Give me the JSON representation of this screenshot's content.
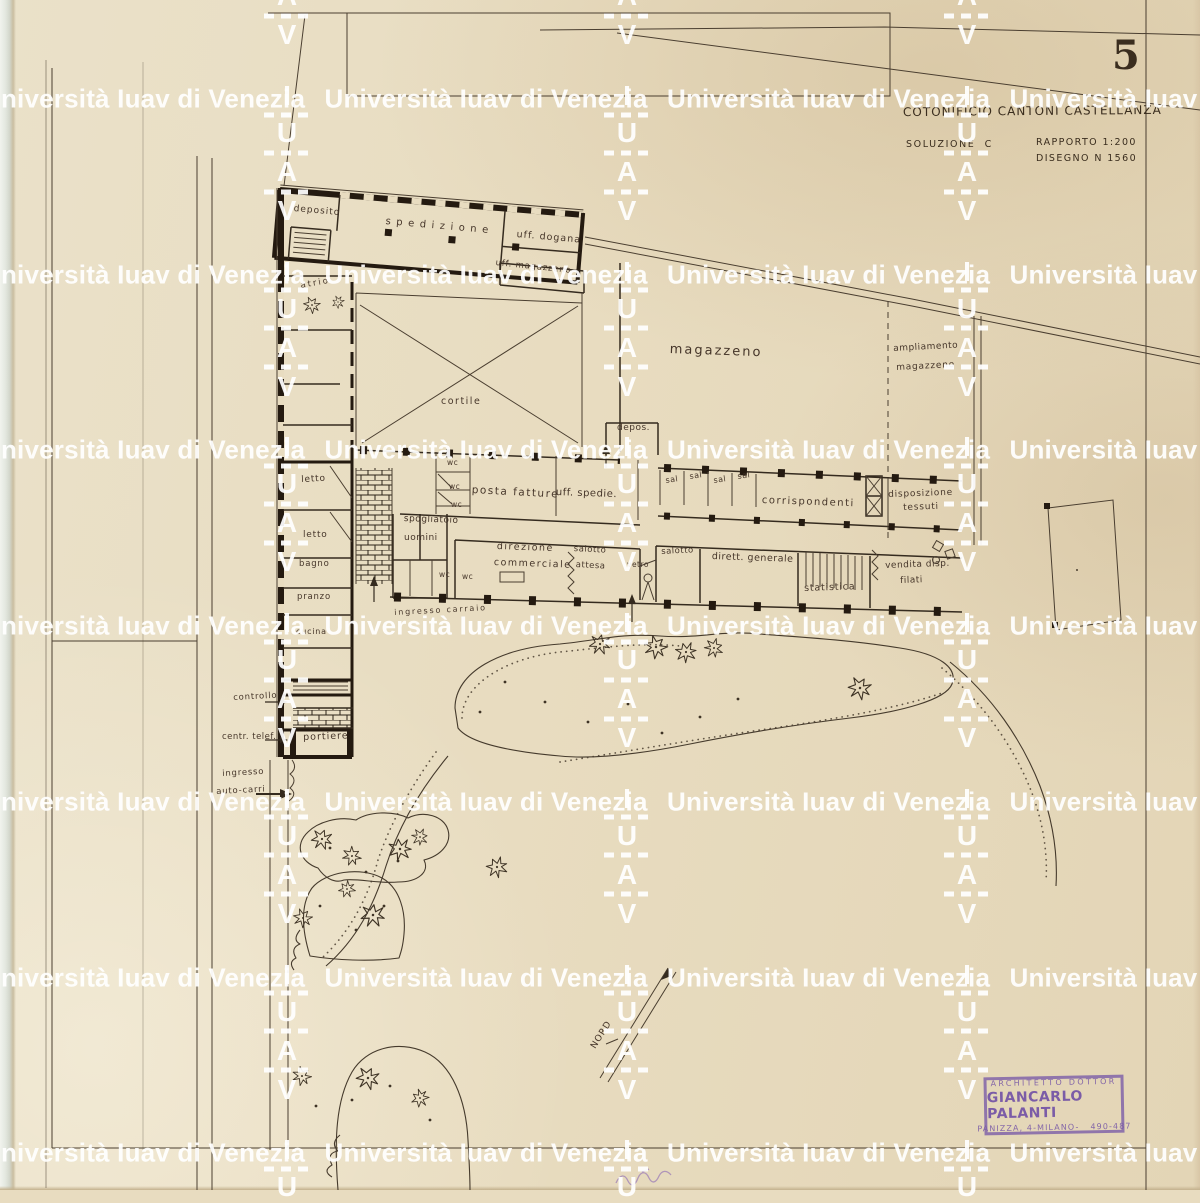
{
  "watermark": {
    "text": "Università Iuav di Venezia",
    "letters": [
      "I",
      "U",
      "A",
      "V"
    ],
    "rows": {
      "y0": 99,
      "dy": 175.7,
      "count": 7
    },
    "text_cols": {
      "x0": -18,
      "dx": 342.5,
      "count": 4
    },
    "letter_cols": {
      "x0": 287,
      "dx": 340,
      "count": 3,
      "y0": 96
    },
    "letter_offsets": [
      0,
      37,
      76,
      115
    ],
    "dash_offsets": [
      18.5,
      56.5,
      95.5
    ]
  },
  "title_block": {
    "sheet_number": "5",
    "title": "COTONIFICIO CANTONI CASTELLANZA",
    "solution": "SOLUZIONE  C",
    "scale": "RAPPORTO 1:200",
    "drawing_number": "DISEGNO N 1560"
  },
  "stamp": {
    "line1": "ARCHITETTO DOTTOR",
    "line2": "GIANCARLO PALANTI",
    "line3": "PANIZZA, 4-MILANO-   490-487"
  },
  "colors": {
    "paper": "#e8dcc0",
    "ink": "#3a2f22",
    "wall": "#241a10",
    "stamp_purple": "#7b5ca7",
    "sheet_number_purple": "#6a4b8f",
    "watermark": "#ffffff"
  },
  "plan_labels": [
    {
      "text": "deposito",
      "x": 294,
      "y": 205,
      "size": 9,
      "rot": 5,
      "ls": 1
    },
    {
      "text": "spedizione",
      "x": 386,
      "y": 217,
      "size": 10,
      "rot": 5,
      "ls": 5.5
    },
    {
      "text": "uff. dogana",
      "x": 517,
      "y": 230,
      "size": 9.5,
      "rot": 5,
      "ls": 1
    },
    {
      "text": "uff. magazzeno",
      "x": 496,
      "y": 259,
      "size": 8.5,
      "rot": 6,
      "ls": 0.8
    },
    {
      "text": "atrio",
      "x": 300,
      "y": 282,
      "size": 8.5,
      "rot": -10,
      "ls": 2
    },
    {
      "text": "cortile",
      "x": 441,
      "y": 397,
      "size": 9.5,
      "rot": 0,
      "ls": 1.5
    },
    {
      "text": "magazzeno",
      "x": 670,
      "y": 343,
      "size": 13,
      "rot": 2,
      "ls": 2
    },
    {
      "text": "ampliamento",
      "x": 893,
      "y": 345,
      "size": 9,
      "rot": -3,
      "ls": 0.5
    },
    {
      "text": "magazzeno",
      "x": 896,
      "y": 364,
      "size": 9,
      "rot": -3,
      "ls": 0.8
    },
    {
      "text": "depos.",
      "x": 617,
      "y": 424,
      "size": 9,
      "rot": 0,
      "ls": 0.5
    },
    {
      "text": "wc",
      "x": 447,
      "y": 459,
      "size": 7.5,
      "rot": 0,
      "ls": 0.5
    },
    {
      "text": "wc",
      "x": 449,
      "y": 483,
      "size": 7.5,
      "rot": 0,
      "ls": 0.5
    },
    {
      "text": "wc",
      "x": 451,
      "y": 501,
      "size": 7.5,
      "rot": 0,
      "ls": 0.5
    },
    {
      "text": "wc",
      "x": 439,
      "y": 571,
      "size": 7.5,
      "rot": 0,
      "ls": 0.5
    },
    {
      "text": "wc",
      "x": 462,
      "y": 573,
      "size": 7.5,
      "rot": 0,
      "ls": 0.5
    },
    {
      "text": "posta fatture",
      "x": 472,
      "y": 485,
      "size": 10.5,
      "rot": 3,
      "ls": 1.5
    },
    {
      "text": "uff. spedie.",
      "x": 556,
      "y": 488,
      "size": 10,
      "rot": 2,
      "ls": 0.5
    },
    {
      "text": "spogliatoio",
      "x": 404,
      "y": 515,
      "size": 9,
      "rot": 2,
      "ls": 0.5
    },
    {
      "text": "uomini",
      "x": 404,
      "y": 534,
      "size": 9,
      "rot": 0,
      "ls": 0.5
    },
    {
      "text": "direzione",
      "x": 497,
      "y": 542,
      "size": 9.5,
      "rot": 2,
      "ls": 1.5
    },
    {
      "text": "commerciale",
      "x": 494,
      "y": 558,
      "size": 9.5,
      "rot": 2,
      "ls": 1.5
    },
    {
      "text": "salotto",
      "x": 574,
      "y": 545,
      "size": 8.5,
      "rot": 3,
      "ls": 0.5
    },
    {
      "text": "attesa",
      "x": 576,
      "y": 561,
      "size": 8.5,
      "rot": 3,
      "ls": 0.5
    },
    {
      "text": "vetro",
      "x": 627,
      "y": 561,
      "size": 7.5,
      "rot": 0,
      "ls": 0.5
    },
    {
      "text": "sal",
      "x": 665,
      "y": 477,
      "size": 8,
      "rot": -8,
      "ls": 0
    },
    {
      "text": "sal",
      "x": 689,
      "y": 473,
      "size": 8,
      "rot": -8,
      "ls": 0
    },
    {
      "text": "sal",
      "x": 713,
      "y": 477,
      "size": 8,
      "rot": -8,
      "ls": 0
    },
    {
      "text": "sal",
      "x": 737,
      "y": 473,
      "size": 8,
      "rot": -8,
      "ls": 0
    },
    {
      "text": "corrispondenti",
      "x": 762,
      "y": 496,
      "size": 10,
      "rot": 2,
      "ls": 1.5
    },
    {
      "text": "disposizione",
      "x": 888,
      "y": 491,
      "size": 9,
      "rot": -2,
      "ls": 0.8
    },
    {
      "text": "tessuti",
      "x": 903,
      "y": 504,
      "size": 9,
      "rot": -2,
      "ls": 0.8
    },
    {
      "text": "salotto",
      "x": 661,
      "y": 548,
      "size": 8.5,
      "rot": -3,
      "ls": 0.5
    },
    {
      "text": "dirett. generale",
      "x": 712,
      "y": 552,
      "size": 9.5,
      "rot": 2,
      "ls": 0.5
    },
    {
      "text": "statistica",
      "x": 804,
      "y": 584,
      "size": 9.5,
      "rot": -2,
      "ls": 0.8
    },
    {
      "text": "vendita disp.",
      "x": 885,
      "y": 562,
      "size": 9,
      "rot": -2,
      "ls": 0.5
    },
    {
      "text": "filati",
      "x": 900,
      "y": 577,
      "size": 9,
      "rot": -2,
      "ls": 0.5
    },
    {
      "text": "letto",
      "x": 301,
      "y": 476,
      "size": 9,
      "rot": -3,
      "ls": 0.8
    },
    {
      "text": "letto",
      "x": 303,
      "y": 531,
      "size": 9,
      "rot": 0,
      "ls": 0.8
    },
    {
      "text": "bagno",
      "x": 299,
      "y": 560,
      "size": 8.5,
      "rot": 0,
      "ls": 0.8
    },
    {
      "text": "pranzo",
      "x": 297,
      "y": 593,
      "size": 8.5,
      "rot": 0,
      "ls": 0.8
    },
    {
      "text": "cucina",
      "x": 296,
      "y": 628,
      "size": 8,
      "rot": 0,
      "ls": 0.8
    },
    {
      "text": "controllo",
      "x": 233,
      "y": 694,
      "size": 8.5,
      "rot": -3,
      "ls": 0.8
    },
    {
      "text": "centr. telef.",
      "x": 222,
      "y": 733,
      "size": 8.5,
      "rot": 0,
      "ls": 0.5
    },
    {
      "text": "portiere",
      "x": 303,
      "y": 733,
      "size": 9.5,
      "rot": -2,
      "ls": 1
    },
    {
      "text": "ingresso",
      "x": 222,
      "y": 770,
      "size": 8.5,
      "rot": -3,
      "ls": 0.8
    },
    {
      "text": "auto-carri",
      "x": 216,
      "y": 788,
      "size": 8.5,
      "rot": -3,
      "ls": 0.8
    },
    {
      "text": "ingresso carraio",
      "x": 394,
      "y": 609,
      "size": 8,
      "rot": -3,
      "ls": 1.8
    },
    {
      "text": "NORD",
      "x": 590,
      "y": 1046,
      "size": 9,
      "rot": -58,
      "ls": 1
    }
  ]
}
